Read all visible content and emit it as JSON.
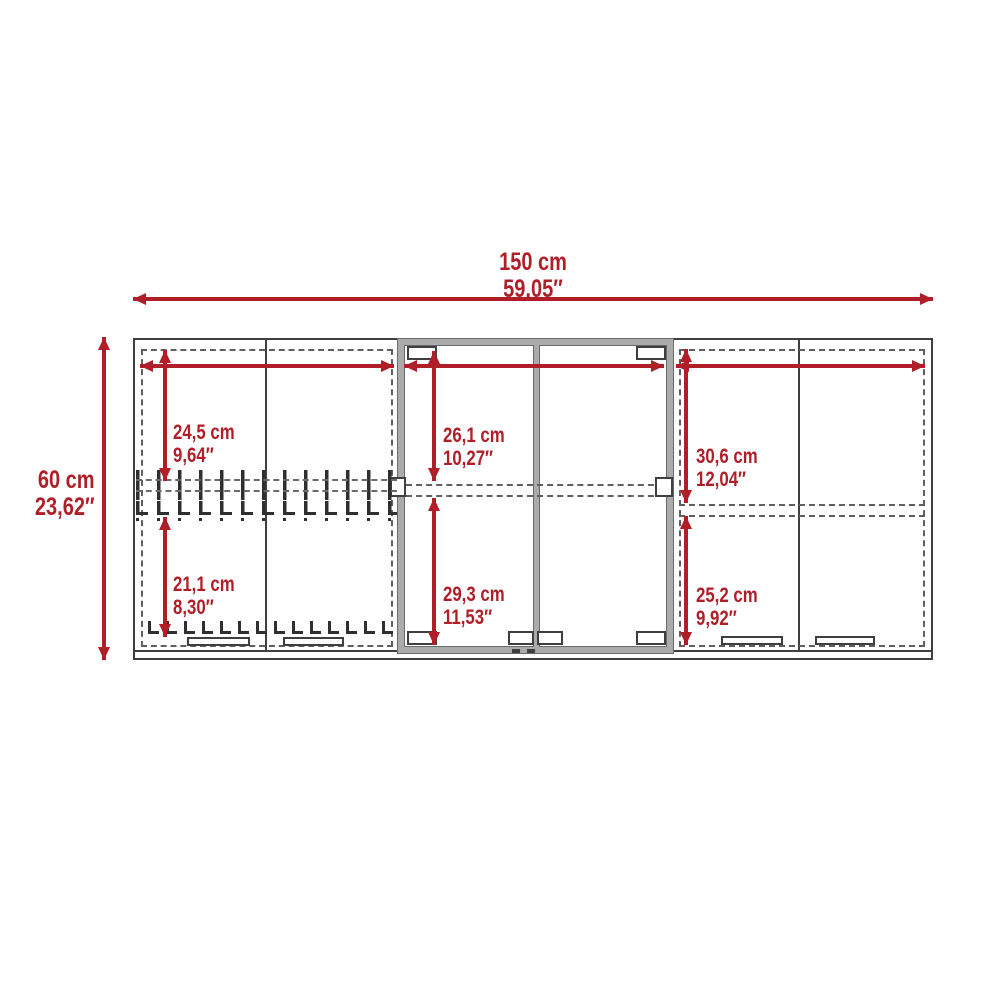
{
  "diagram": {
    "type": "furniture-dimension-diagram",
    "subject": "wall cabinet front elevation with three sections (double-door, glass double-door, double-door)"
  },
  "colors": {
    "dimension_red": "#b01e28",
    "line_dark": "#3f3f3f",
    "frame_gray": "#ababab",
    "dash_gray": "#5f5f5f"
  },
  "dimensions": {
    "overall_width": {
      "cm": "150 cm",
      "inch": "59,05″"
    },
    "overall_height": {
      "cm": "60 cm",
      "inch": "23,62″"
    },
    "left_top": {
      "cm": "24,5 cm",
      "inch": "9,64″"
    },
    "left_bottom": {
      "cm": "21,1 cm",
      "inch": "8,30″"
    },
    "center_top": {
      "cm": "26,1 cm",
      "inch": "10,27″"
    },
    "center_bottom": {
      "cm": "29,3 cm",
      "inch": "11,53″"
    },
    "right_top": {
      "cm": "30,6 cm",
      "inch": "12,04″"
    },
    "right_bottom": {
      "cm": "25,2 cm",
      "inch": "9,92″"
    }
  }
}
